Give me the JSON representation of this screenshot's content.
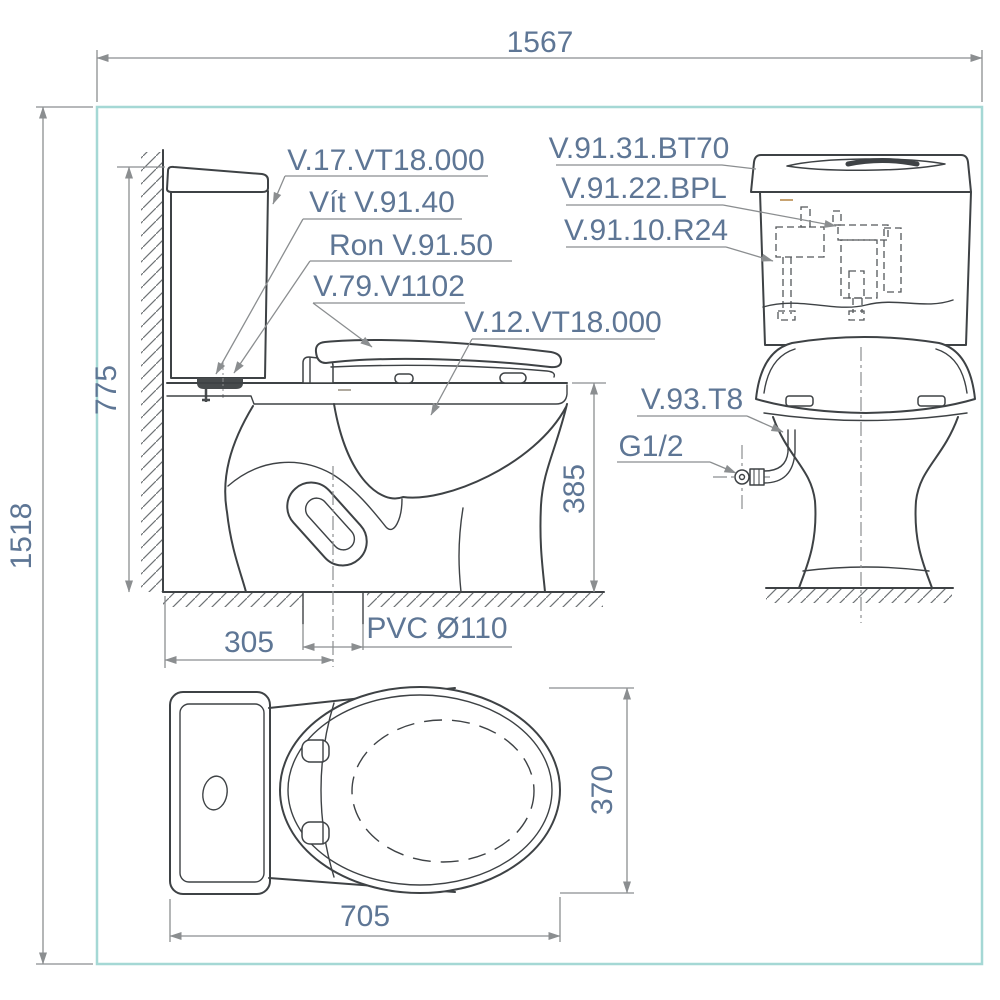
{
  "drawing_type": "toilet installation technical drawing (side view, front view, plan view)",
  "colors": {
    "border": "#a5d8d5",
    "outline": "#3e4245",
    "dimension": "#8b8e90",
    "text": "#5e7695"
  },
  "dims": {
    "overall_width": "1567",
    "overall_height": "1518",
    "tank_height": "775",
    "bowl_height": "385",
    "rough_in": "305",
    "outlet_pipe": "PVC Ø110",
    "depth": "705",
    "width": "370"
  },
  "parts": {
    "tank": "V.17.VT18.000",
    "screw": "Vít V.91.40",
    "gasket": "Ron V.91.50",
    "seat_cover": "V.79.V1102",
    "bowl": "V.12.VT18.000",
    "tank_lid": "V.91.31.BT70",
    "flush_valve": "V.91.22.BPL",
    "fill_valve": "V.91.10.R24",
    "supply_hose": "V.93.T8",
    "water_inlet": "G1/2"
  }
}
